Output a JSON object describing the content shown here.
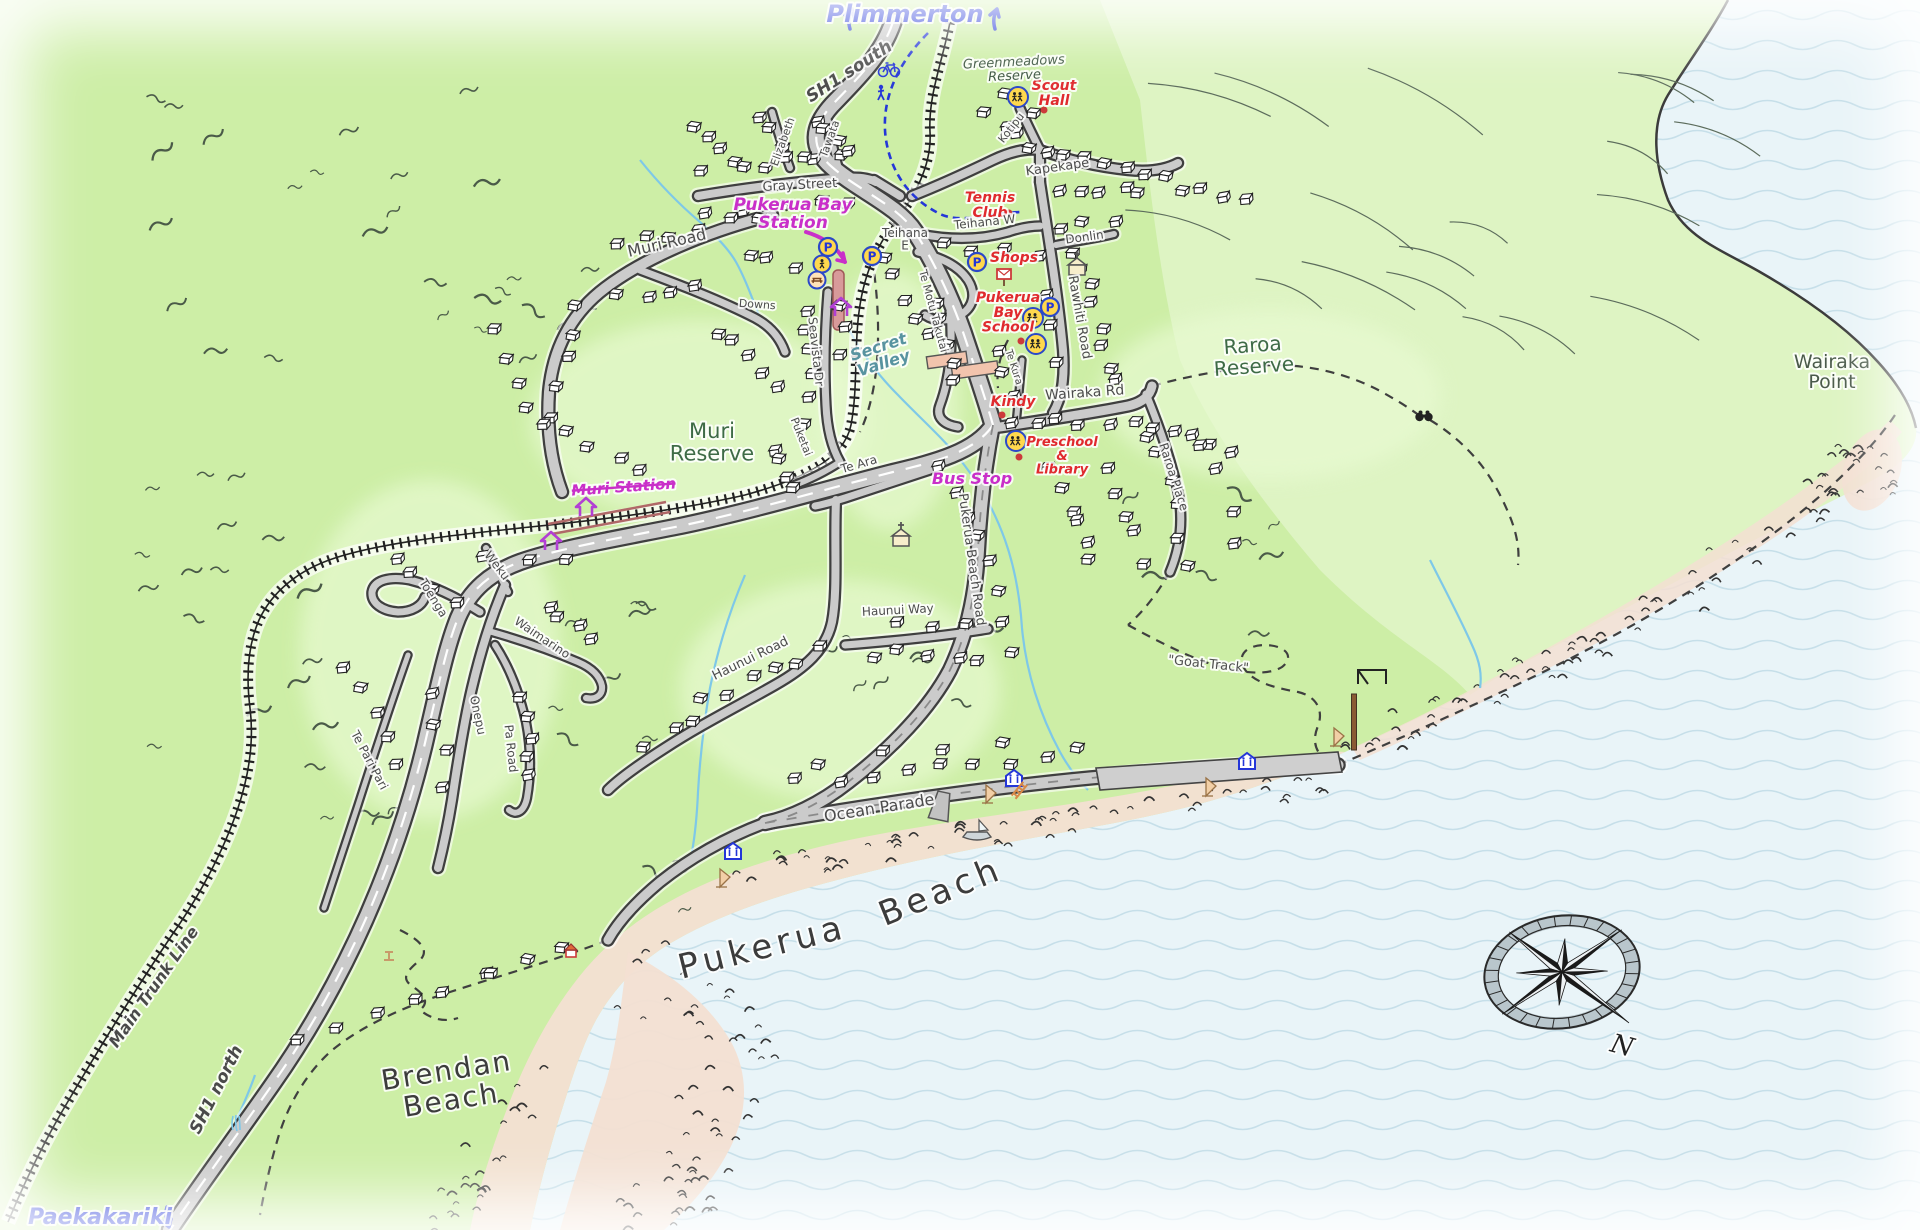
{
  "map_title": "Pukerua Bay hand-drawn map",
  "colors": {
    "land": "#cdeea6",
    "hills_ne": "#e0f5c8",
    "sea": "#e9f4f8",
    "waves": "#c6dfe9",
    "sand": "#f3dfd2",
    "road_fill": "#cbcbcb",
    "road_casing": "#3f3f3f",
    "rail": "#222222",
    "stream": "#7ec8e8",
    "platform": "#d89a9a",
    "nav_blue": "#2436d8",
    "transit_magenta": "#c92fc9",
    "poi_red": "#e02a2e",
    "reserve_green": "#3e6b46",
    "shop_building": "#f2c4ad"
  },
  "nav": {
    "top_destination": "Plimmerton",
    "bottom_destination": "Paekakariki"
  },
  "labels": [
    {
      "n": "plimmerton",
      "t": "Plimmerton",
      "x": 905,
      "y": 22,
      "r": 0,
      "c": "nav",
      "s": 24
    },
    {
      "n": "paekakariki",
      "t": "Paekakariki",
      "x": 100,
      "y": 1224,
      "r": 0,
      "c": "nav",
      "s": 22
    },
    {
      "n": "sh1-south",
      "t": "SH1 south",
      "x": 852,
      "y": 76,
      "r": -33,
      "c": "hwy",
      "s": 17
    },
    {
      "n": "sh1-north",
      "t": "SH1 north",
      "x": 221,
      "y": 1092,
      "r": -63,
      "c": "hwy",
      "s": 17
    },
    {
      "n": "main-trunk-line",
      "t": "Main Trunk Line",
      "x": 158,
      "y": 990,
      "r": -55,
      "c": "hwy",
      "s": 16
    },
    {
      "n": "pukerua-bay-station",
      "t": "Pukerua Bay\nStation",
      "x": 793,
      "y": 210,
      "r": 0,
      "c": "transit",
      "s": 17
    },
    {
      "n": "muri-station",
      "t": "Muri Station",
      "x": 624,
      "y": 492,
      "r": -4,
      "c": "transit",
      "s": 15,
      "strike": true
    },
    {
      "n": "bus-stop",
      "t": "Bus Stop",
      "x": 972,
      "y": 484,
      "r": 0,
      "c": "transit",
      "s": 16
    },
    {
      "n": "scout-hall",
      "t": "Scout\nHall",
      "x": 1054,
      "y": 90,
      "r": 0,
      "c": "poi",
      "s": 14
    },
    {
      "n": "tennis-club",
      "t": "Tennis\nClub",
      "x": 990,
      "y": 202,
      "r": 0,
      "c": "poi",
      "s": 14
    },
    {
      "n": "shops",
      "t": "Shops",
      "x": 1014,
      "y": 262,
      "r": 0,
      "c": "poi",
      "s": 14
    },
    {
      "n": "pukerua-bay-school",
      "t": "Pukerua\nBay\nSchool",
      "x": 1008,
      "y": 302,
      "r": 0,
      "c": "poi",
      "s": 14
    },
    {
      "n": "kindy",
      "t": "Kindy",
      "x": 1013,
      "y": 406,
      "r": 0,
      "c": "poi",
      "s": 14
    },
    {
      "n": "preschool-library",
      "t": "Preschool\n&\nLibrary",
      "x": 1062,
      "y": 446,
      "r": 0,
      "c": "poi",
      "s": 13
    },
    {
      "n": "muri-reserve",
      "t": "Muri\nReserve",
      "x": 712,
      "y": 438,
      "r": 0,
      "c": "reserve",
      "s": 21
    },
    {
      "n": "raroa-reserve",
      "t": "Raroa\nReserve",
      "x": 1253,
      "y": 352,
      "r": -4,
      "c": "reserve",
      "s": 20
    },
    {
      "n": "greenmeadows-reserve",
      "t": "Greenmeadows\nReserve",
      "x": 1014,
      "y": 66,
      "r": -3,
      "c": "reserve-sm",
      "s": 13
    },
    {
      "n": "wairaka-point",
      "t": "Wairaka\nPoint",
      "x": 1832,
      "y": 368,
      "r": 0,
      "c": "coast",
      "s": 19
    },
    {
      "n": "secret-valley",
      "t": "Secret\nValley",
      "x": 880,
      "y": 352,
      "r": -18,
      "c": "water",
      "s": 16
    },
    {
      "n": "pukerua-beach-word1",
      "t": "Pukerua",
      "x": 765,
      "y": 958,
      "r": -14,
      "c": "beach",
      "s": 34,
      "ls": 5
    },
    {
      "n": "pukerua-beach-word2",
      "t": "Beach",
      "x": 945,
      "y": 902,
      "r": -22,
      "c": "beach",
      "s": 34,
      "ls": 5
    },
    {
      "n": "brendan-beach",
      "t": "Brendan\nBeach",
      "x": 448,
      "y": 1080,
      "r": -9,
      "c": "beach",
      "s": 28,
      "ls": 2
    },
    {
      "n": "goat-track",
      "t": "\"Goat Track\"",
      "x": 1208,
      "y": 668,
      "r": 6,
      "c": "track",
      "s": 13
    },
    {
      "n": "muri-road",
      "t": "Muri Road",
      "x": 668,
      "y": 248,
      "r": -13,
      "c": "road",
      "s": 16
    },
    {
      "n": "gray-street",
      "t": "Gray Street",
      "x": 800,
      "y": 189,
      "r": -3,
      "c": "road",
      "s": 13
    },
    {
      "n": "elizabeth",
      "t": "Elizabeth",
      "x": 786,
      "y": 143,
      "r": -70,
      "c": "road",
      "s": 11
    },
    {
      "n": "tawata",
      "t": "Tawata",
      "x": 833,
      "y": 140,
      "r": -70,
      "c": "road",
      "s": 11
    },
    {
      "n": "kotipu",
      "t": "Kotipu",
      "x": 1014,
      "y": 130,
      "r": -52,
      "c": "road",
      "s": 11
    },
    {
      "n": "kapekape",
      "t": "Kapekape",
      "x": 1058,
      "y": 171,
      "r": -8,
      "c": "road",
      "s": 13
    },
    {
      "n": "teihana-w",
      "t": "Teihana W",
      "x": 985,
      "y": 226,
      "r": -6,
      "c": "road",
      "s": 12
    },
    {
      "n": "teihana-e",
      "t": "Teihana\nE",
      "x": 905,
      "y": 237,
      "r": 0,
      "c": "road",
      "s": 12
    },
    {
      "n": "donlin",
      "t": "Donlin",
      "x": 1085,
      "y": 241,
      "r": -8,
      "c": "road",
      "s": 12
    },
    {
      "n": "rawhiti-road",
      "t": "Rawhiti Road",
      "x": 1076,
      "y": 318,
      "r": 80,
      "c": "road",
      "s": 13
    },
    {
      "n": "wairaka-rd",
      "t": "Wairaka Rd",
      "x": 1085,
      "y": 397,
      "r": -4,
      "c": "road",
      "s": 14
    },
    {
      "n": "raroa-place",
      "t": "Raroa Place",
      "x": 1170,
      "y": 478,
      "r": 72,
      "c": "road",
      "s": 12
    },
    {
      "n": "te-motu-takutai",
      "t": "Te Motu Takutai",
      "x": 930,
      "y": 312,
      "r": 75,
      "c": "road",
      "s": 11
    },
    {
      "n": "seavista-dr",
      "t": "Seavista Dr",
      "x": 812,
      "y": 352,
      "r": 84,
      "c": "road",
      "s": 12
    },
    {
      "n": "puketai",
      "t": "Puketai",
      "x": 798,
      "y": 438,
      "r": 68,
      "c": "road",
      "s": 11
    },
    {
      "n": "downs",
      "t": "Downs",
      "x": 757,
      "y": 308,
      "r": 4,
      "c": "road",
      "s": 11
    },
    {
      "n": "te-kura",
      "t": "Te Kura",
      "x": 1011,
      "y": 368,
      "r": 72,
      "c": "road",
      "s": 10
    },
    {
      "n": "te-ara",
      "t": "Te Ara",
      "x": 860,
      "y": 468,
      "r": -16,
      "c": "road",
      "s": 12
    },
    {
      "n": "pukerua-beach-road",
      "t": "Pukerua Beach Road",
      "x": 968,
      "y": 560,
      "r": 82,
      "c": "road",
      "s": 13
    },
    {
      "n": "haunui-way",
      "t": "Haunui Way",
      "x": 898,
      "y": 614,
      "r": -3,
      "c": "road",
      "s": 12
    },
    {
      "n": "haunui-road",
      "t": "Haunui Road",
      "x": 752,
      "y": 662,
      "r": -26,
      "c": "road",
      "s": 13
    },
    {
      "n": "toenga",
      "t": "Toenga",
      "x": 430,
      "y": 600,
      "r": 58,
      "c": "road",
      "s": 12
    },
    {
      "n": "weku",
      "t": "Weku",
      "x": 494,
      "y": 568,
      "r": 52,
      "c": "road",
      "s": 12
    },
    {
      "n": "waimarino",
      "t": "Waimarino",
      "x": 540,
      "y": 641,
      "r": 34,
      "c": "road",
      "s": 12
    },
    {
      "n": "onepu",
      "t": "Onepu",
      "x": 474,
      "y": 716,
      "r": 78,
      "c": "road",
      "s": 12
    },
    {
      "n": "pa-road",
      "t": "Pa Road",
      "x": 507,
      "y": 749,
      "r": 84,
      "c": "road",
      "s": 12
    },
    {
      "n": "te-pari-pari",
      "t": "Te Pari Pari",
      "x": 366,
      "y": 762,
      "r": 62,
      "c": "road",
      "s": 12
    },
    {
      "n": "ocean-parade",
      "t": "Ocean Parade",
      "x": 880,
      "y": 813,
      "r": -9,
      "c": "road",
      "s": 16
    },
    {
      "n": "compass-n",
      "t": "N",
      "x": 1620,
      "y": 1054,
      "r": 15,
      "c": "compass",
      "s": 26
    }
  ],
  "icons": [
    {
      "type": "parking",
      "x": 828,
      "y": 247
    },
    {
      "type": "parking",
      "x": 872,
      "y": 256
    },
    {
      "type": "parking",
      "x": 977,
      "y": 262
    },
    {
      "type": "parking",
      "x": 1050,
      "y": 307
    },
    {
      "type": "school",
      "x": 1033,
      "y": 318
    },
    {
      "type": "school",
      "x": 1036,
      "y": 344
    },
    {
      "type": "school",
      "x": 1016,
      "y": 441
    },
    {
      "type": "school",
      "x": 1018,
      "y": 97
    },
    {
      "type": "crossing",
      "x": 822,
      "y": 264
    },
    {
      "type": "picnic",
      "x": 817,
      "y": 280
    },
    {
      "type": "church",
      "x": 1077,
      "y": 267
    },
    {
      "type": "church",
      "x": 901,
      "y": 538
    },
    {
      "type": "postbox",
      "x": 1004,
      "y": 278
    },
    {
      "type": "toilet",
      "x": 733,
      "y": 852
    },
    {
      "type": "toilet",
      "x": 1014,
      "y": 779
    },
    {
      "type": "toilet",
      "x": 1247,
      "y": 762
    },
    {
      "type": "boat",
      "x": 977,
      "y": 833
    },
    {
      "type": "bicycle",
      "x": 889,
      "y": 68
    },
    {
      "type": "walker",
      "x": 881,
      "y": 94
    },
    {
      "type": "binoculars",
      "x": 1424,
      "y": 417
    },
    {
      "type": "sail",
      "x": 720,
      "y": 878
    },
    {
      "type": "sail",
      "x": 986,
      "y": 794
    },
    {
      "type": "sail",
      "x": 1206,
      "y": 787
    },
    {
      "type": "sail",
      "x": 1334,
      "y": 737
    },
    {
      "type": "steps",
      "x": 1019,
      "y": 790
    },
    {
      "type": "stile",
      "x": 389,
      "y": 955
    },
    {
      "type": "hut",
      "x": 571,
      "y": 951
    },
    {
      "type": "pole",
      "x": 1354,
      "y": 722
    },
    {
      "type": "frame",
      "x": 1372,
      "y": 676
    },
    {
      "type": "waterfall",
      "x": 236,
      "y": 1124
    },
    {
      "type": "ramp",
      "x": 941,
      "y": 806
    },
    {
      "type": "dot",
      "x": 1009,
      "y": 213
    },
    {
      "type": "dot",
      "x": 1021,
      "y": 341
    },
    {
      "type": "dot",
      "x": 1002,
      "y": 415
    },
    {
      "type": "dot",
      "x": 1019,
      "y": 457
    },
    {
      "type": "dot",
      "x": 1044,
      "y": 110
    },
    {
      "type": "navup",
      "x": 851,
      "y": 18
    },
    {
      "type": "navup",
      "x": 996,
      "y": 18
    },
    {
      "type": "navdown",
      "x": 168,
      "y": 1218
    },
    {
      "type": "chev",
      "x": 841,
      "y": 308
    },
    {
      "type": "chev",
      "x": 586,
      "y": 508
    },
    {
      "type": "chev",
      "x": 551,
      "y": 542
    },
    {
      "type": "starrow",
      "x": 0,
      "y": 0
    }
  ],
  "decor": {
    "house_rows": [
      [
        702,
        168,
        846,
        158,
        6
      ],
      [
        706,
        208,
        852,
        198,
        5
      ],
      [
        756,
        120,
        800,
        158,
        4
      ],
      [
        816,
        118,
        852,
        156,
        4
      ],
      [
        690,
        130,
        740,
        165,
        4
      ],
      [
        612,
        248,
        758,
        214,
        6
      ],
      [
        576,
        300,
        556,
        420,
        5
      ],
      [
        620,
        300,
        700,
        285,
        4
      ],
      [
        806,
        310,
        806,
        420,
        6
      ],
      [
        844,
        300,
        844,
        360,
        3
      ],
      [
        722,
        330,
        775,
        392,
        5
      ],
      [
        775,
        445,
        792,
        492,
        4
      ],
      [
        490,
        330,
        540,
        430,
        5
      ],
      [
        565,
        435,
        645,
        470,
        4
      ],
      [
        986,
        118,
        1032,
        148,
        4
      ],
      [
        1046,
        158,
        1130,
        162,
        5
      ],
      [
        1062,
        192,
        1142,
        188,
        5
      ],
      [
        1150,
        172,
        1240,
        205,
        6
      ],
      [
        1058,
        230,
        1112,
        224,
        3
      ],
      [
        1078,
        252,
        1112,
        382,
        8
      ],
      [
        1038,
        262,
        1052,
        360,
        4
      ],
      [
        884,
        262,
        930,
        330,
        5
      ],
      [
        940,
        300,
        952,
        382,
        5
      ],
      [
        938,
        246,
        1002,
        250,
        3
      ],
      [
        995,
        352,
        1010,
        395,
        3
      ],
      [
        1012,
        422,
        1130,
        418,
        6
      ],
      [
        1148,
        424,
        1235,
        452,
        5
      ],
      [
        1152,
        432,
        1188,
        560,
        6
      ],
      [
        1205,
        440,
        1240,
        540,
        4
      ],
      [
        1052,
        472,
        1092,
        560,
        6
      ],
      [
        1102,
        470,
        1142,
        558,
        5
      ],
      [
        942,
        472,
        988,
        556,
        5
      ],
      [
        1000,
        592,
        1012,
        652,
        3
      ],
      [
        872,
        652,
        982,
        656,
        5
      ],
      [
        902,
        622,
        962,
        620,
        3
      ],
      [
        702,
        700,
        822,
        648,
        6
      ],
      [
        648,
        742,
        692,
        722,
        3
      ],
      [
        800,
        782,
        1082,
        752,
        9
      ],
      [
        820,
        760,
        1000,
        742,
        4
      ],
      [
        302,
        1042,
        482,
        978,
        6
      ],
      [
        490,
        968,
        565,
        948,
        3
      ],
      [
        348,
        662,
        395,
        762,
        5
      ],
      [
        432,
        692,
        448,
        782,
        4
      ],
      [
        524,
        692,
        534,
        780,
        5
      ],
      [
        392,
        562,
        452,
        600,
        4
      ],
      [
        545,
        602,
        592,
        638,
        4
      ],
      [
        485,
        556,
        562,
        560,
        3
      ],
      [
        1008,
        96,
        1032,
        112,
        2
      ],
      [
        752,
        252,
        790,
        268,
        3
      ]
    ],
    "rock_zones": [
      {
        "pts": [
          [
            736,
            870
          ],
          [
            900,
            845
          ],
          [
            1060,
            824
          ],
          [
            1200,
            802
          ],
          [
            1326,
            776
          ]
        ],
        "n": 60,
        "s": 16
      },
      {
        "pts": [
          [
            1352,
            754
          ],
          [
            1470,
            702
          ],
          [
            1600,
            642
          ],
          [
            1702,
            585
          ],
          [
            1800,
            522
          ],
          [
            1858,
            464
          ]
        ],
        "n": 70,
        "s": 20
      },
      {
        "pts": [
          [
            648,
            962
          ],
          [
            706,
            1012
          ],
          [
            744,
            1064
          ],
          [
            726,
            1124
          ],
          [
            688,
            1172
          ],
          [
            656,
            1214
          ]
        ],
        "n": 60,
        "s": 42
      },
      {
        "pts": [
          [
            545,
            1072
          ],
          [
            505,
            1132
          ],
          [
            465,
            1192
          ],
          [
            438,
            1226
          ]
        ],
        "n": 26,
        "s": 22
      },
      {
        "pts": [
          [
            1856,
            440
          ],
          [
            1884,
            474
          ],
          [
            1898,
            504
          ]
        ],
        "n": 12,
        "s": 12
      }
    ],
    "scrub_boxes": [
      [
        150,
        90,
        340,
        280,
        20
      ],
      [
        460,
        250,
        160,
        150,
        7
      ],
      [
        125,
        430,
        190,
        360,
        16
      ],
      [
        545,
        600,
        170,
        150,
        8
      ],
      [
        800,
        625,
        190,
        130,
        10
      ],
      [
        1030,
        460,
        250,
        200,
        8
      ],
      [
        305,
        700,
        115,
        150,
        5
      ],
      [
        585,
        840,
        120,
        90,
        4
      ]
    ],
    "contour_box": [
      1160,
      75,
      560,
      270,
      18
    ]
  }
}
